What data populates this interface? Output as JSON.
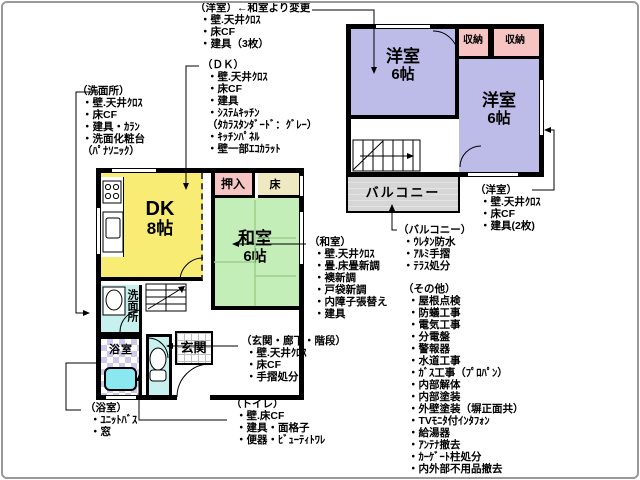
{
  "colors": {
    "wall": "#000000",
    "western_room": "#bdbbe8",
    "closet": "#f6c5c3",
    "tokonoma": "#eee9c0",
    "dk": "#f8ec74",
    "japanese_room": "#c4eeb8",
    "washroom": "#c7f1ef",
    "bath_tile": "#cfc9ee",
    "bathtub": "#8ce8f0",
    "toilet_room": "#c7f1ef",
    "balcony": "#d3d3d3",
    "entrance_tile_line": "#bfbfbf",
    "frame": "#999999"
  },
  "floor2": {
    "room_left": {
      "name": "洋室",
      "size": "6帖"
    },
    "room_right": {
      "name": "洋室",
      "size": "6帖"
    },
    "closet_left": "収納",
    "closet_right": "収納",
    "balcony": "バルコニー"
  },
  "floor1": {
    "dk": {
      "name": "DK",
      "size": "8帖"
    },
    "oshiire": "押入",
    "toko": "床",
    "washitsu": {
      "name": "和室",
      "size": "6帖"
    },
    "senmenjo": "洗面所",
    "yokushitsu": "浴室",
    "genkan": "玄関"
  },
  "annotations": {
    "yoshitsu_changed": {
      "lines": [
        "（洋室）←和室より変更",
        "・壁.天井ｸﾛｽ",
        "・床CF",
        "・建具（3枚）"
      ]
    },
    "dk": {
      "lines": [
        "（ＤＫ）",
        "・壁.天井ｸﾛｽ",
        "・床CF",
        "・建具",
        "・ｼｽﾃﾑｷｯﾁﾝ",
        "（ﾀｶﾗｽﾀﾝﾀﾞｰﾄﾞ：ｸﾞﾚｰ）",
        "・ｷｯﾁﾝﾊﾟﾈﾙ",
        "・壁一部ｴｺｶﾗｯﾄ"
      ]
    },
    "senmenjo": {
      "lines": [
        "（洗面所）",
        "・壁.天井ｸﾛｽ",
        "・床CF",
        "・建具・ｶﾗﾝ",
        "・洗面化粧台",
        "（ﾊﾟﾅｿﾆｯｸ）"
      ]
    },
    "washitsu": {
      "lines": [
        "（和室）",
        "・壁.天井ｸﾛｽ",
        "・畳.床畳新調",
        "・襖新調",
        "・戸袋新調",
        "・内障子張替え",
        "・建具"
      ]
    },
    "genkan_hall": {
      "lines": [
        "（玄関・廊下・階段）",
        "・壁.天井ｸﾛｽ",
        "・床CF",
        "・手摺処分"
      ]
    },
    "yokushitsu": {
      "lines": [
        "（浴室）",
        "・ﾕﾆｯﾄﾊﾞｽ",
        "・窓"
      ]
    },
    "toilet": {
      "lines": [
        "（トイレ）",
        "・壁.床CF",
        "・建具・面格子",
        "・便器・ﾋﾞｭｰﾃｨﾄﾜﾚ"
      ]
    },
    "yoshitsu_2f": {
      "lines": [
        "（洋室）",
        "・壁.天井ｸﾛｽ",
        "・床CF",
        "・建具(2枚)"
      ]
    },
    "balcony": {
      "lines": [
        "（バルコニー）",
        "・ｳﾚﾀﾝ防水",
        "・ｱﾙﾐ手摺",
        "・ﾃﾗｽ処分"
      ]
    },
    "other": {
      "lines": [
        "（その他）",
        "・屋根点検",
        "・防蟻工事",
        "・電気工事",
        "・分電盤",
        "・警報器",
        "・水道工事",
        "・ｶﾞｽ工事（ﾌﾟﾛﾊﾟﾝ）",
        "・内部解体",
        "・内部塗装",
        "・外壁塗装（塀正面共）",
        "・TVﾓﾆﾀ付ｲﾝﾀﾌｫﾝ",
        "・給湯器",
        "・ｱﾝﾃﾅ撤去",
        "・ｶｰｹﾞｰﾄ柱処分",
        "・内外部不用品撤去"
      ]
    }
  }
}
